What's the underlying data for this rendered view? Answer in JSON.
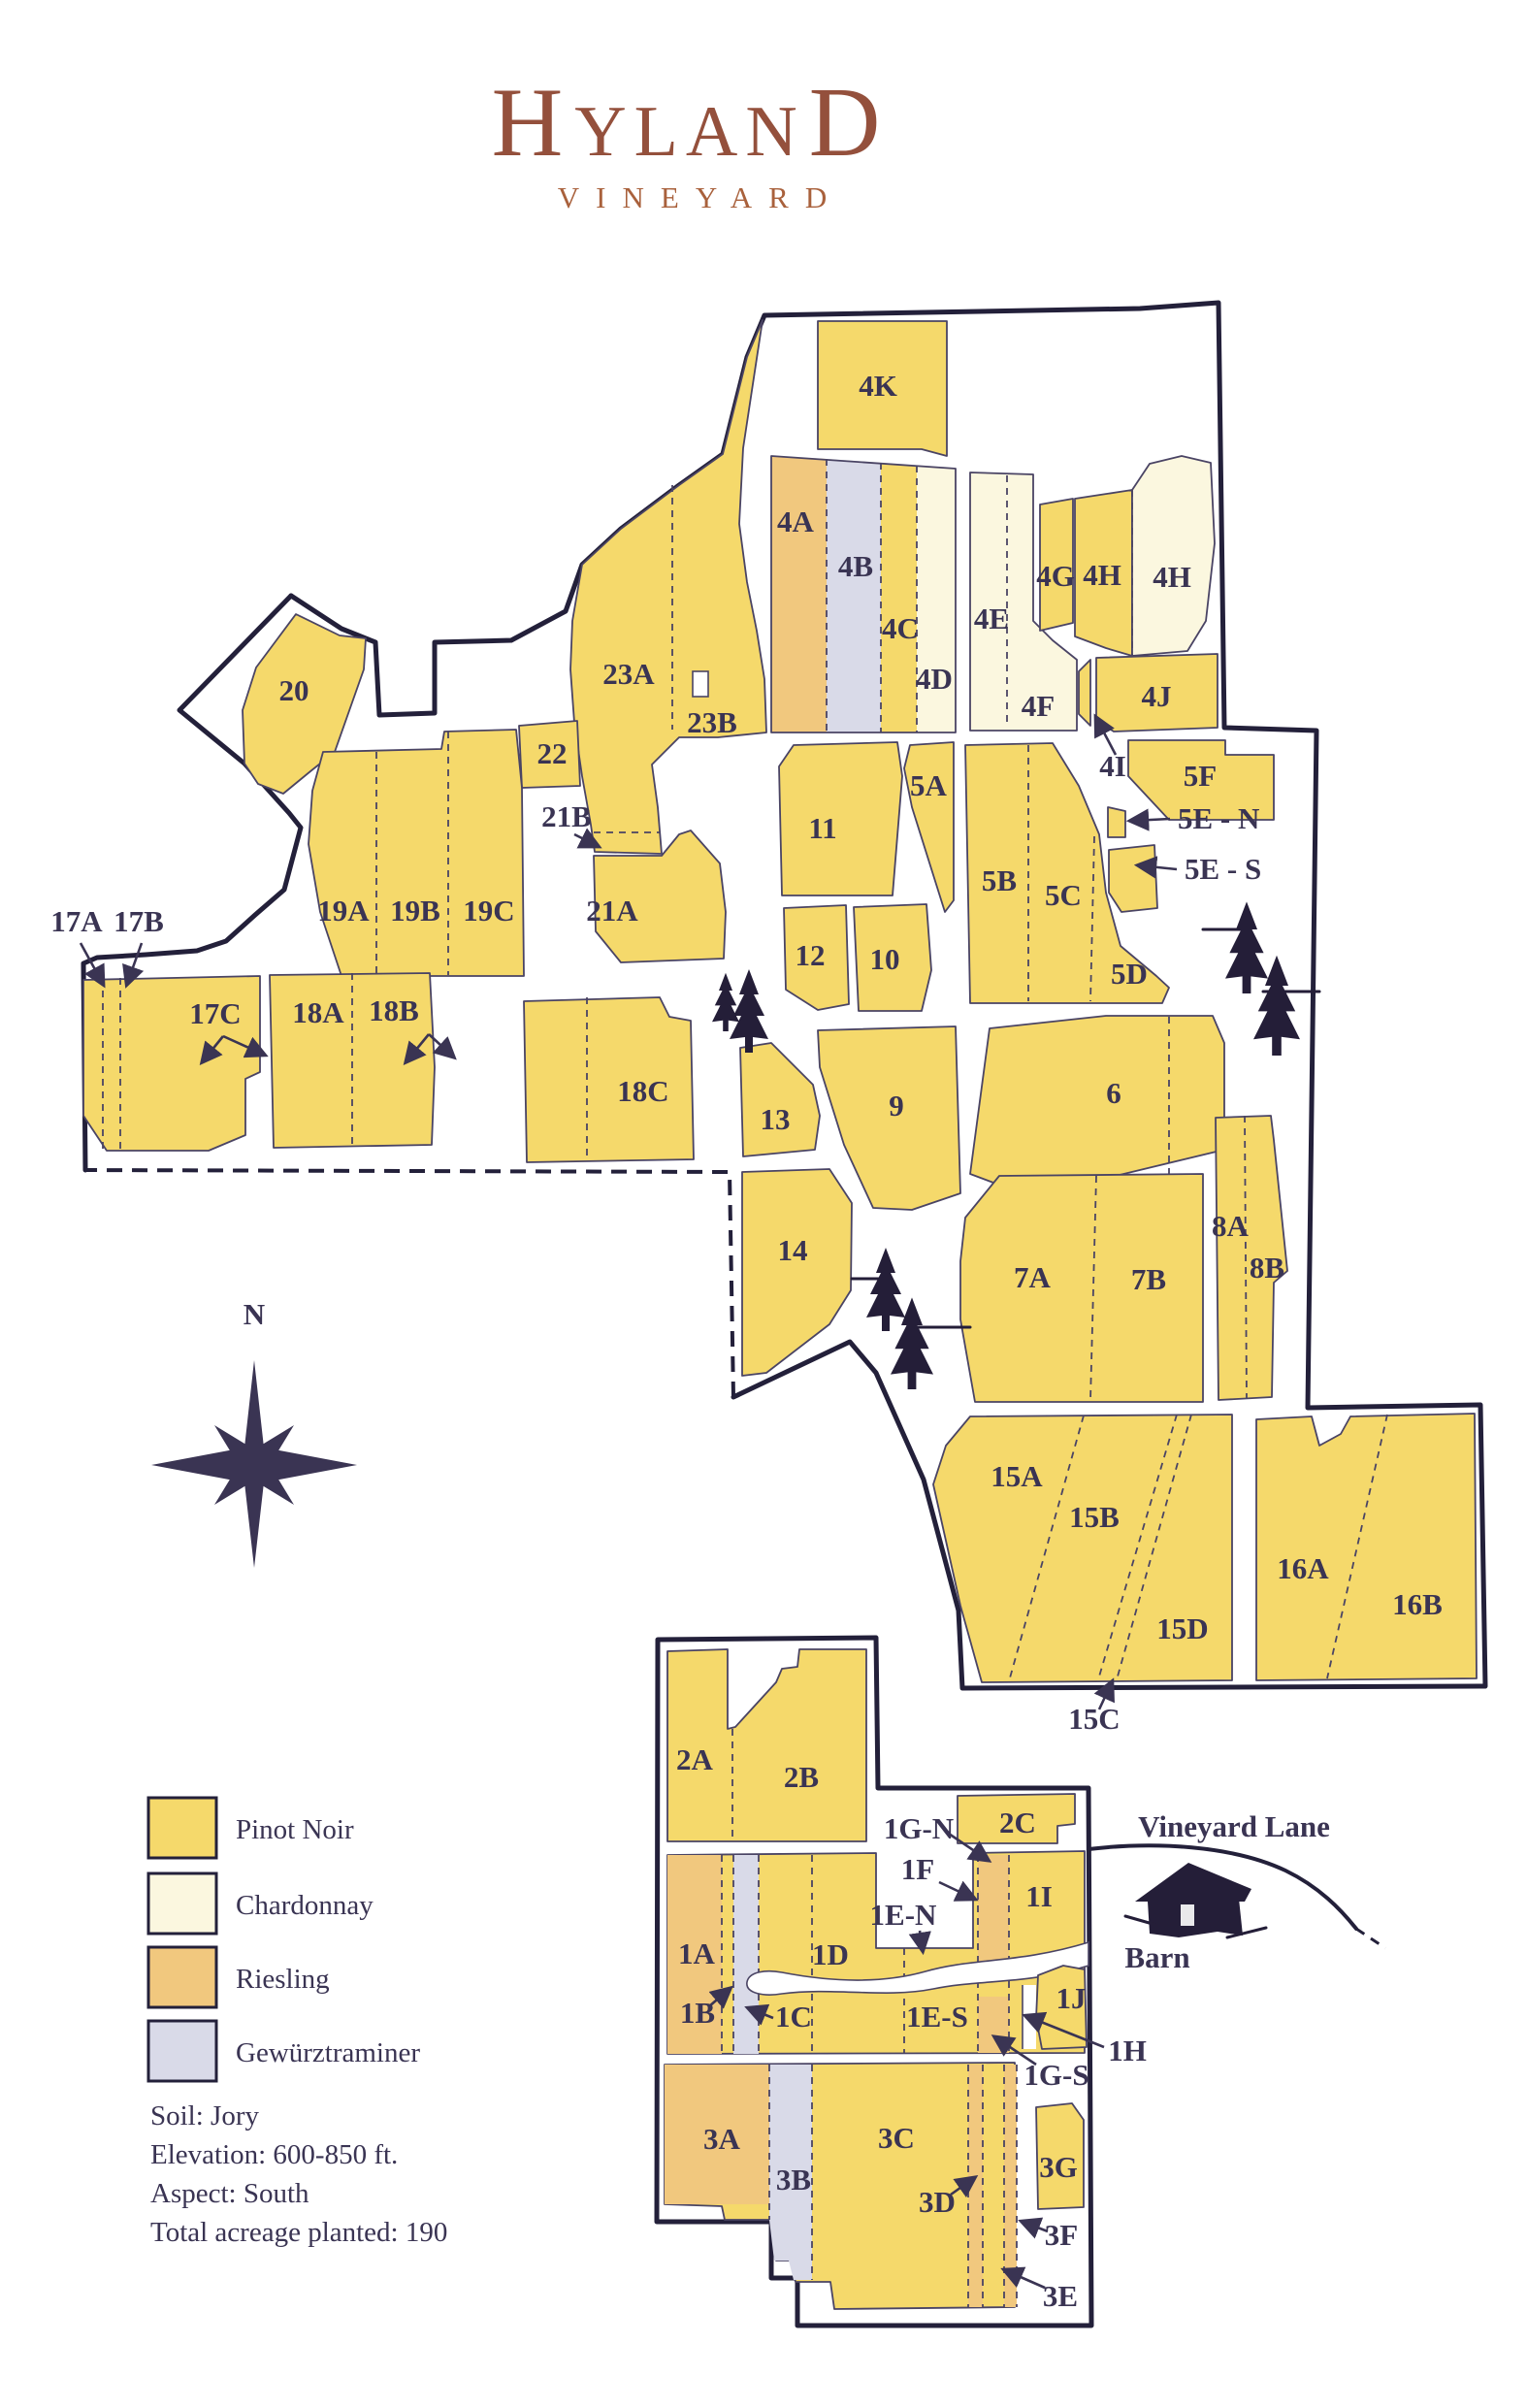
{
  "title": {
    "first": "H",
    "middle": "YLAN",
    "last": "D",
    "subtitle": "VINEYARD"
  },
  "compass": {
    "north": "N"
  },
  "landmarks": {
    "lane": "Vineyard Lane",
    "barn": "Barn"
  },
  "legend": {
    "items": [
      {
        "id": "pinot",
        "label": "Pinot Noir"
      },
      {
        "id": "chardonnay",
        "label": "Chardonnay"
      },
      {
        "id": "riesling",
        "label": "Riesling"
      },
      {
        "id": "gewurztraminer",
        "label": "Gewürztraminer"
      }
    ]
  },
  "info": {
    "soil": "Soil: Jory",
    "elevation": "Elevation: 600-850 ft.",
    "aspect": "Aspect: South",
    "acreage": "Total acreage planted: 190"
  },
  "blocks": {
    "4K": "4K",
    "4A": "4A",
    "4B": "4B",
    "4C": "4C",
    "4D": "4D",
    "4E": "4E",
    "4F": "4F",
    "4G": "4G",
    "4H_w": "4H",
    "4H_e": "4H",
    "4I": "4I",
    "4J": "4J",
    "5A": "5A",
    "5B": "5B",
    "5C": "5C",
    "5D": "5D",
    "5E_N": "5E - N",
    "5E_S": "5E - S",
    "5F": "5F",
    "6": "6",
    "7A": "7A",
    "7B": "7B",
    "8A": "8A",
    "8B": "8B",
    "9": "9",
    "10": "10",
    "11": "11",
    "12": "12",
    "13": "13",
    "14": "14",
    "15A": "15A",
    "15B": "15B",
    "15C": "15C",
    "15D": "15D",
    "16A": "16A",
    "16B": "16B",
    "17A": "17A",
    "17B": "17B",
    "17C": "17C",
    "18A": "18A",
    "18B": "18B",
    "18C": "18C",
    "19A": "19A",
    "19B": "19B",
    "19C": "19C",
    "20": "20",
    "21A": "21A",
    "21B": "21B",
    "22": "22",
    "23A": "23A",
    "23B": "23B",
    "1A": "1A",
    "1B": "1B",
    "1C": "1C",
    "1D": "1D",
    "1E_N": "1E-N",
    "1E_S": "1E-S",
    "1F": "1F",
    "1G_N": "1G-N",
    "1G_S": "1G-S",
    "1H": "1H",
    "1I": "1I",
    "1J": "1J",
    "2A": "2A",
    "2B": "2B",
    "2C": "2C",
    "3A": "3A",
    "3B": "3B",
    "3C": "3C",
    "3D": "3D",
    "3E": "3E",
    "3F": "3F",
    "3G": "3G"
  },
  "icons": {
    "compass": "compass-rose",
    "tree": "evergreen-tree",
    "barn": "barn-sketch",
    "building": "small-building"
  },
  "colors": {
    "pinot": "#F5D96B",
    "chardonnay": "#FBF7DF",
    "riesling": "#F1C87E",
    "gewurztraminer": "#D9DAE8",
    "boundary": "#23203A",
    "edge": "#4A4464",
    "ink": "#3A3453",
    "title": "#94503C",
    "subtitle": "#A9613C",
    "tree": "#241E38"
  }
}
